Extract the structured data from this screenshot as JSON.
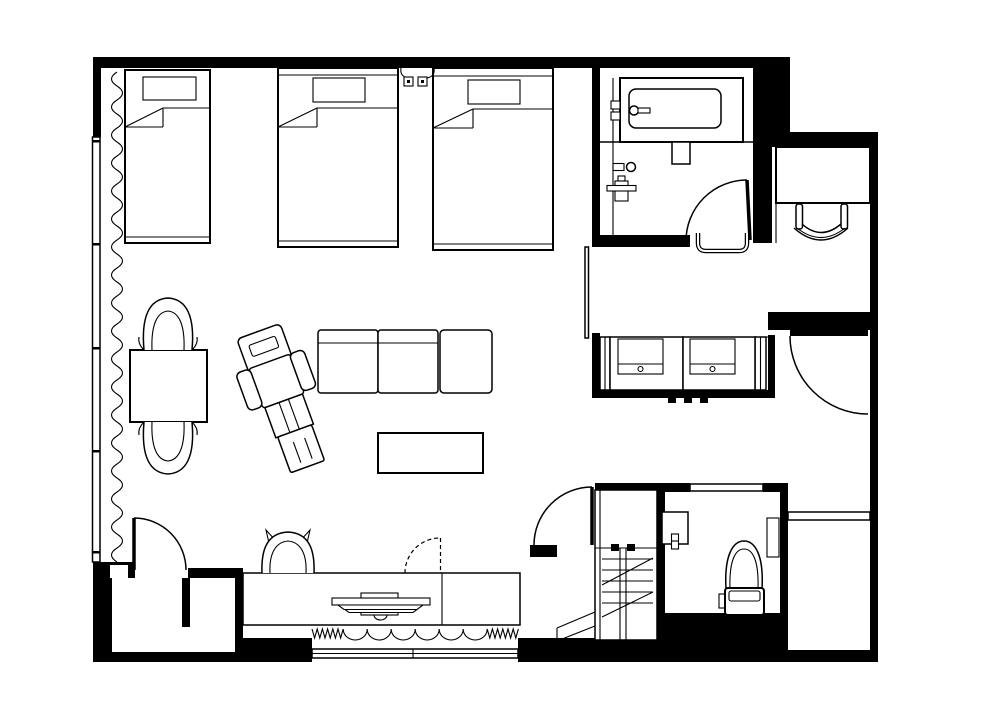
{
  "meta": {
    "type": "architectural-floor-plan",
    "text_visible": false,
    "canvas": {
      "w": 1000,
      "h": 718
    }
  },
  "colors": {
    "wall": "#000000",
    "line": "#000000",
    "floor": "#ffffff",
    "background": "#ffffff"
  },
  "labels": {
    "floorplan": "Hotel suite floor plan, black and white line drawing",
    "bed_1": "Single bed with pillow and folded blanket",
    "bed_2": "Bed with pillow and folded blanket",
    "bed_3": "Bed with pillow and folded blanket",
    "reading_lights": "Two wall-mounted reading lights between beds",
    "curtain": "Wavy curtain along window wall",
    "window_left": "Full-height window wall, left side",
    "window_bottom": "Window in bottom wall",
    "dining_table": "Square table",
    "dining_chair_top": "Armchair at table, upper",
    "dining_chair_bottom": "Armchair at table, lower",
    "lounge_chair": "Reclining lounge chair, angled",
    "sofa": "Sofa with two back sections and ottoman",
    "coffee_table": "Low rectangular table",
    "console": "Long sideboard console",
    "tv": "Flat television on console, plan view",
    "stool": "Chair at console",
    "folding_door": "Concealed swing shown dashed",
    "valance": "Scalloped valance over bottom window",
    "niche": "Recessed niche at lower left",
    "niche_door": "Niche door swinging into room",
    "bathroom": "Bathroom with tub",
    "bathtub": "Bathtub on platform",
    "tub_faucet": "Bath filler and handles",
    "wall_taps": "Wall-mounted taps and mixer",
    "bathroom_door": "Bathroom door",
    "towel_bar": "Towel bar outside bathroom door",
    "desk": "Built-in desk in nook",
    "desk_chair": "Desk chair",
    "wardrobe": "Recessed wardrobe with two drawer units",
    "entry_door": "Entry door",
    "wc_room": "Toilet and shower room",
    "wc_door": "Toilet lobby door",
    "shower_unit": "Slatted shower / bench unit",
    "washbasin": "Small washbasin",
    "toilet": "Toilet with tank",
    "shelf": "Wall shelf beside toilet",
    "closet_shelf": "Shelf in right-hand closet"
  },
  "inventory": {
    "beds": 3,
    "sofa_sections": 3,
    "wardrobe_drawers": 2,
    "doors_swing": 5,
    "doors_dashed": 1,
    "windows": 2,
    "chairs": 4
  }
}
